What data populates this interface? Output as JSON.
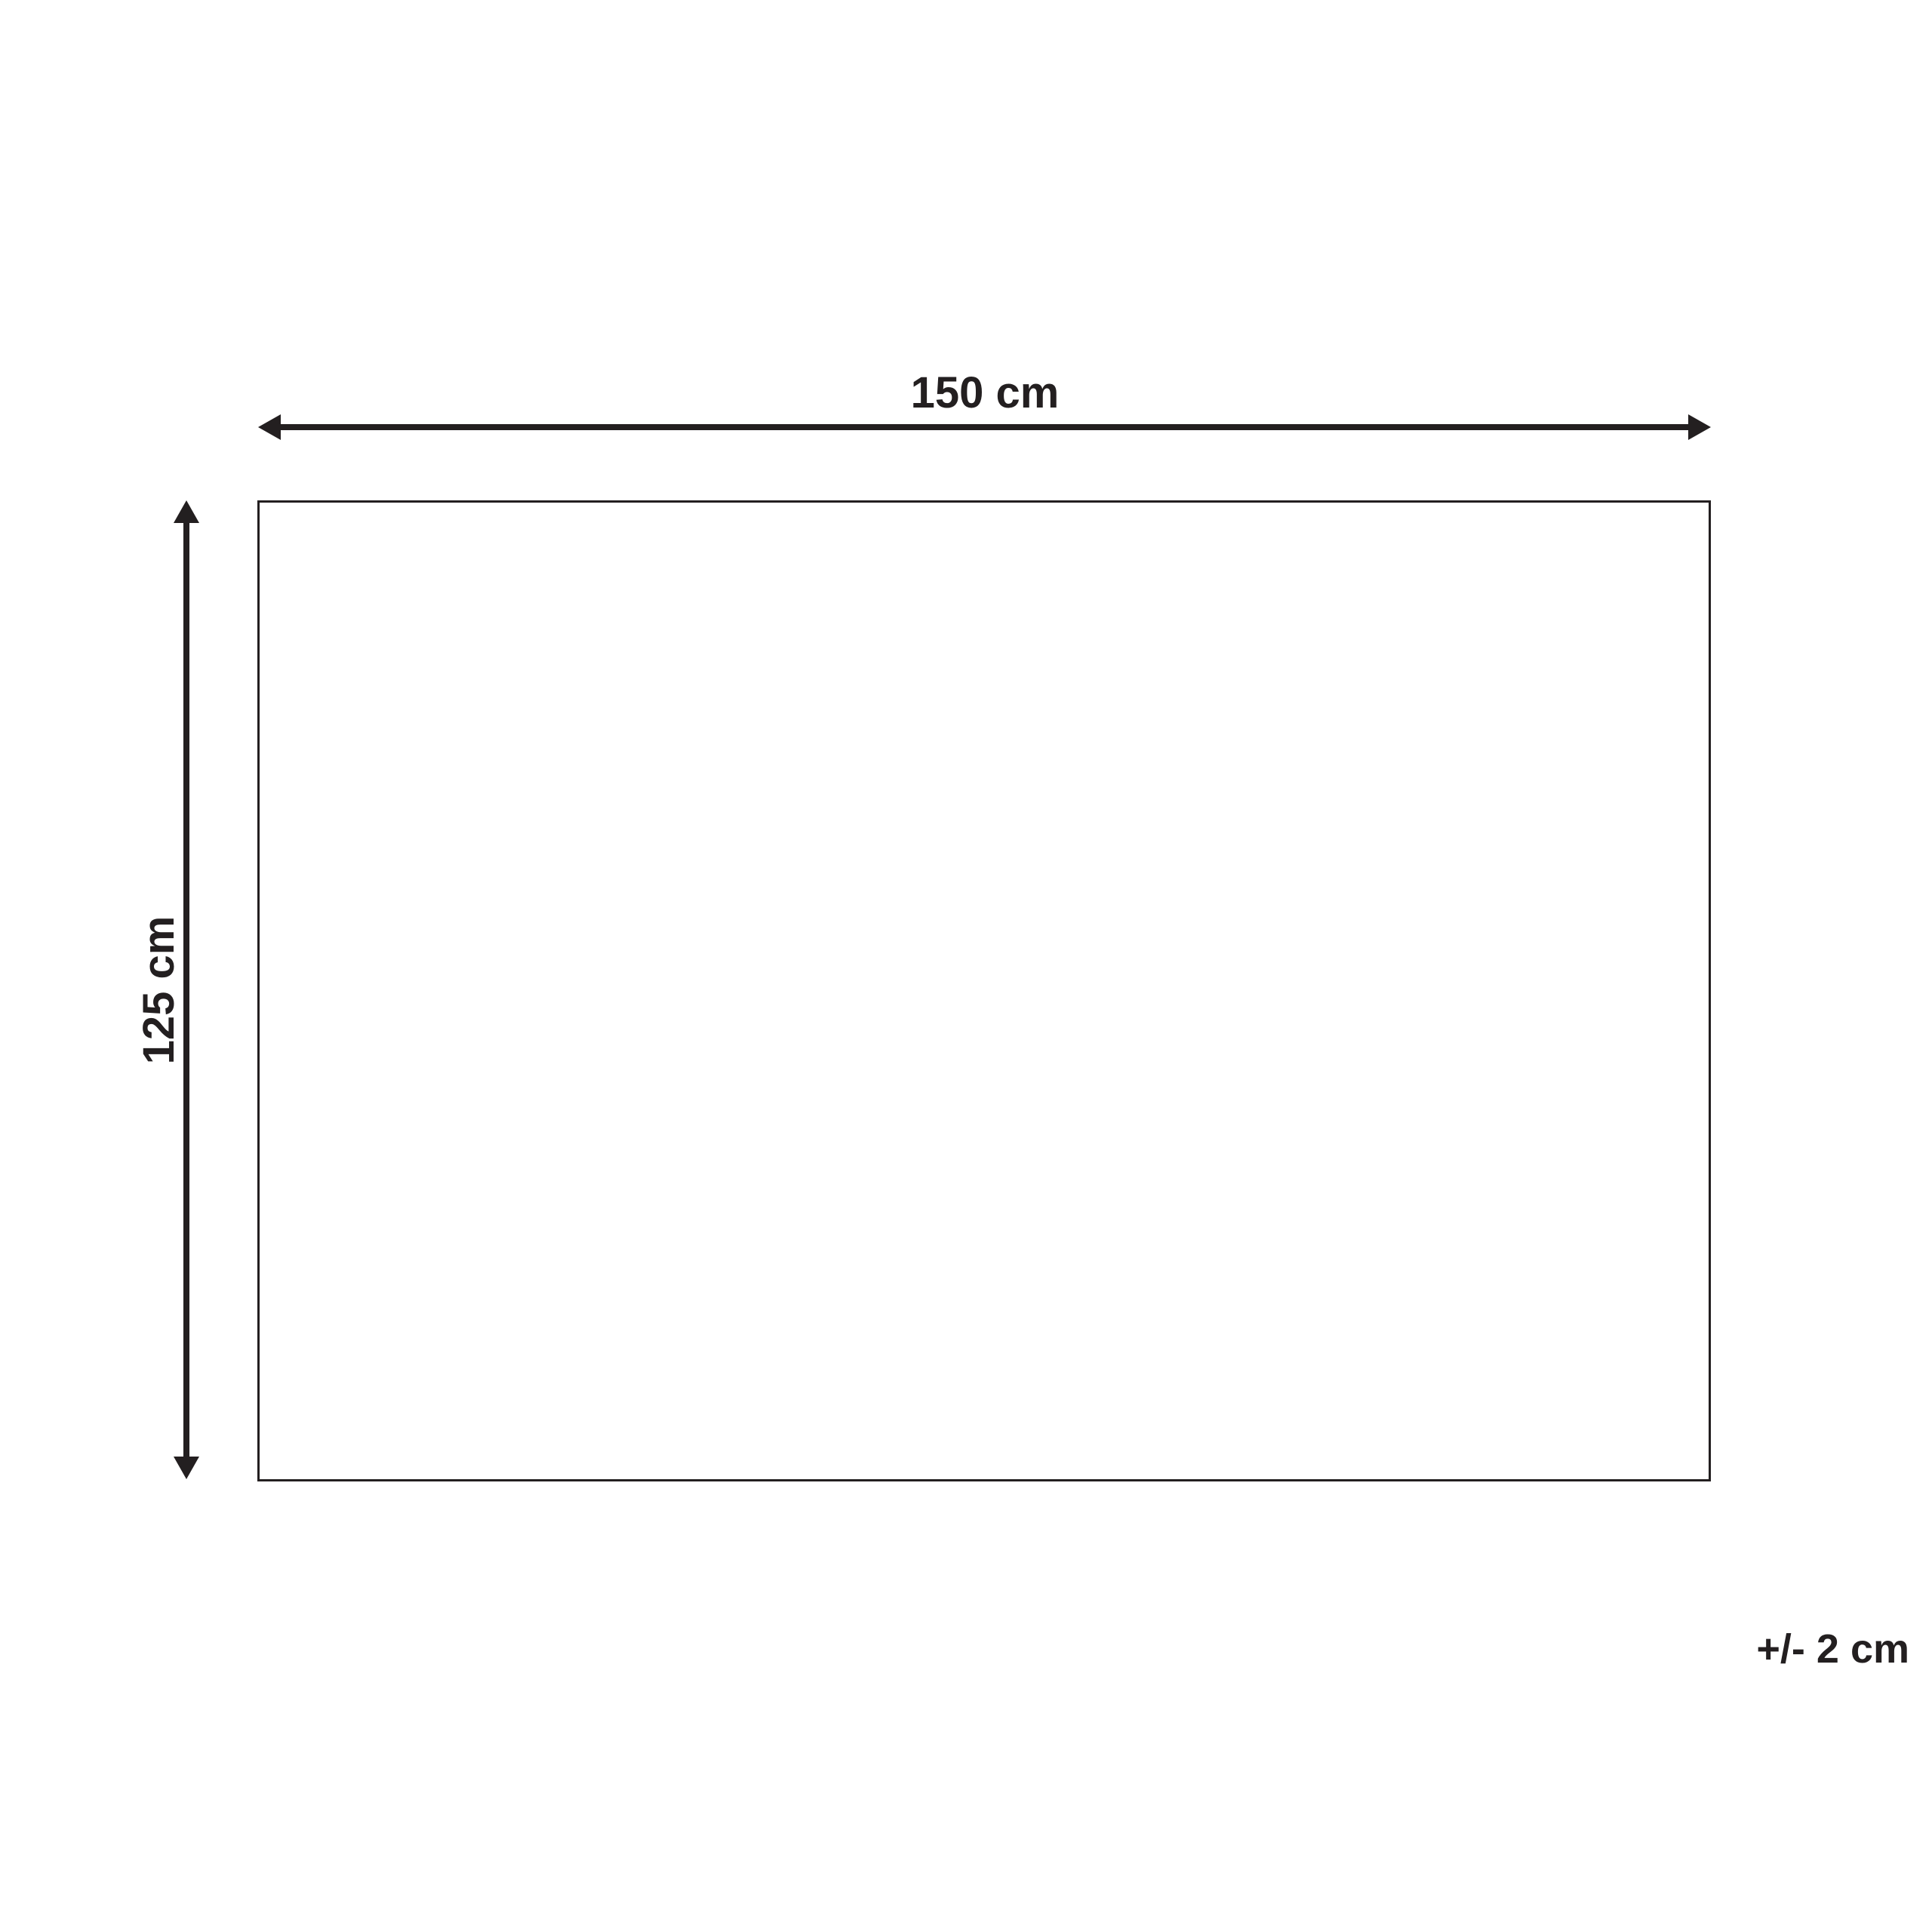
{
  "diagram": {
    "type": "product-dimension-diagram",
    "width_label": "150 cm",
    "height_label": "125 cm",
    "tolerance_label": "+/- 2 cm",
    "line_color": "#231f20",
    "background_color": "#ffffff"
  }
}
